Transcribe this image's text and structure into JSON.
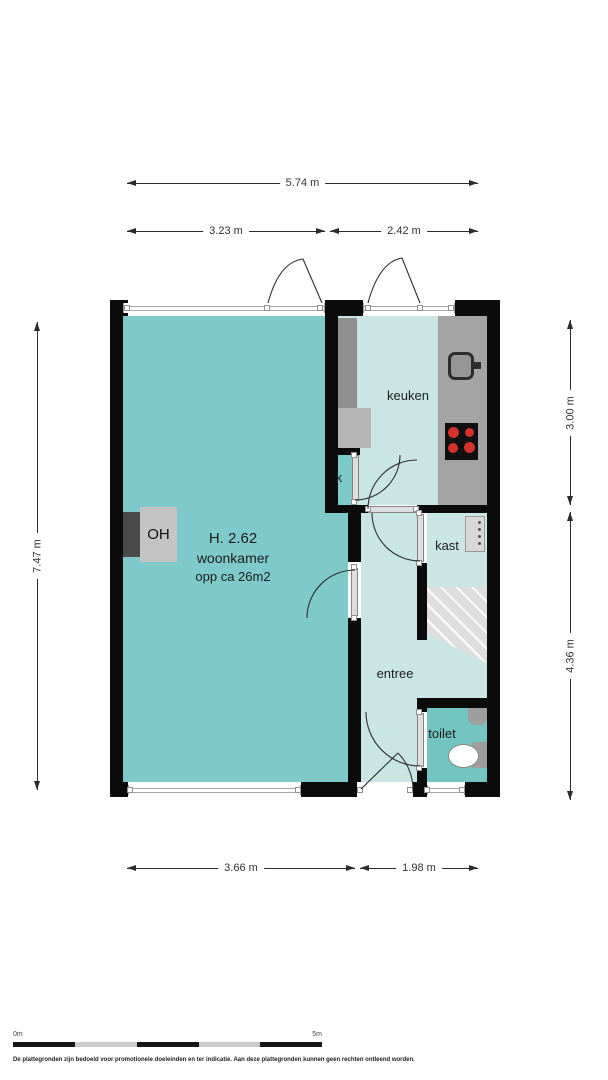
{
  "rooms": {
    "woonkamer": {
      "height_label": "H. 2.62",
      "name": "woonkamer",
      "area_label": "opp ca 26m2"
    },
    "keuken": {
      "name": "keuken"
    },
    "kast": {
      "name": "kast"
    },
    "entree": {
      "name": "entree"
    },
    "toilet": {
      "name": "toilet"
    },
    "closet": {
      "name": "k"
    },
    "fireplace": {
      "name": "OH"
    }
  },
  "dimensions": {
    "top_total": "5.74 m",
    "top_left": "3.23 m",
    "top_right": "2.42 m",
    "left_height": "7.47 m",
    "right_top": "3.00 m",
    "right_bottom": "4.36 m",
    "bottom_left": "3.66 m",
    "bottom_right": "1.98 m"
  },
  "scale_bar": {
    "start": "0m",
    "end": "5m"
  },
  "disclaimer": "De plattegronden zijn bedoeld voor promotionele doeleinden en ter indicatie. Aan deze plattegronden kunnen geen rechten ontleend worden.",
  "icons": {
    "sink": "rounded-square-basin-with-faucet",
    "cooktop": "black-panel-four-red-burners",
    "stairs": "diagonal-tread-lines",
    "toilet": "bowl-with-cistern",
    "hand_basin": "small-wall-basin",
    "meter_cabinet": "panel-with-dots",
    "fireplace": "OH-box-on-wall"
  },
  "colors": {
    "room_primary": "#7ecaca",
    "room_secondary": "#c9e6e4",
    "toilet_fill": "#72c5c3",
    "wall": "#0b0b0b",
    "counter": "#a4a4a4",
    "stairs": "#dedede",
    "burner": "#d4302c"
  }
}
